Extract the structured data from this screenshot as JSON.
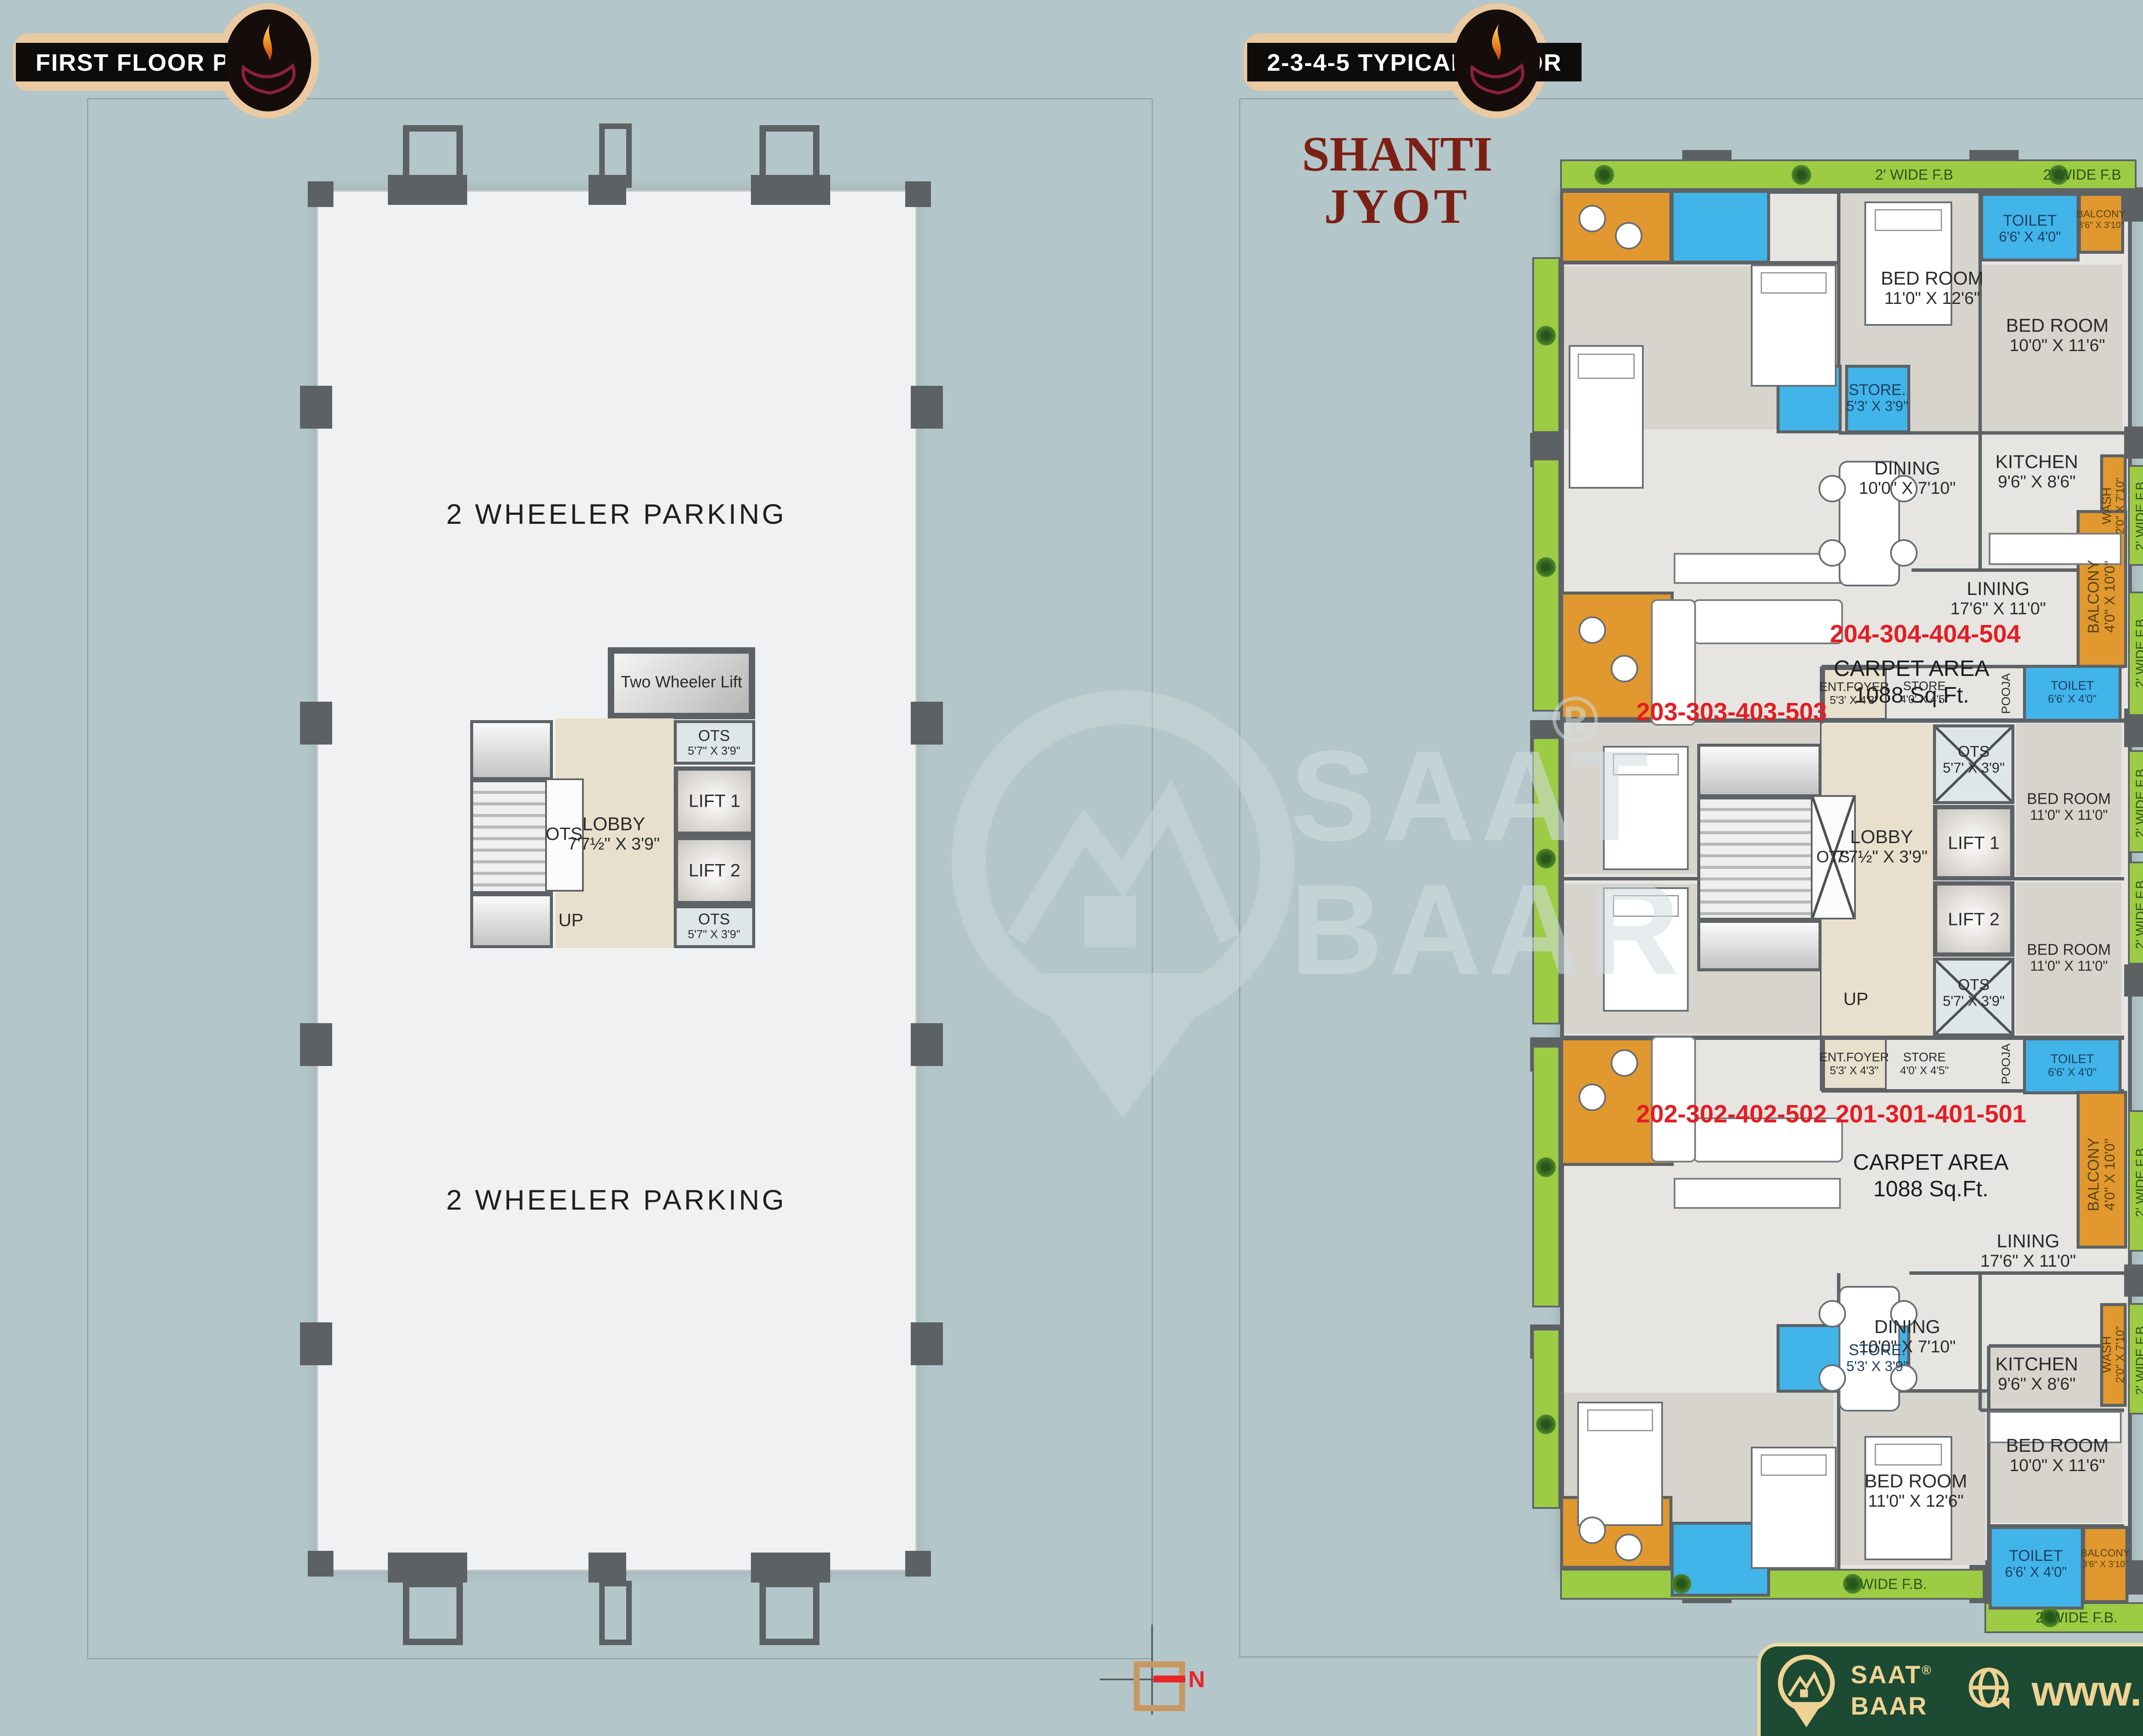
{
  "headers": {
    "left": "FIRST FLOOR PLAN",
    "right": "2-3-4-5 TYPICAL FLOOR"
  },
  "brand": {
    "line1": "SHANTI",
    "line2": "JYOT"
  },
  "watermark": {
    "word1": "SAAT",
    "word2": "BAAR",
    "reg": "®"
  },
  "north": {
    "label": "N"
  },
  "footer": {
    "name_line1": "SAAT",
    "name_line2": "BAAR",
    "reg": "®",
    "website": "www.saatbaar.com"
  },
  "left_plan": {
    "parking_top": "2 WHEELER PARKING",
    "parking_bottom": "2 WHEELER PARKING",
    "two_wheeler_lift": {
      "l1": "Two",
      "l2": "Wheeler",
      "l3": "Lift"
    },
    "ots_top": {
      "name": "OTS",
      "dim": "5'7\" X 3'9\""
    },
    "lift1": "LIFT 1",
    "lift2": "LIFT 2",
    "ots_bottom": {
      "name": "OTS",
      "dim": "5'7\" X 3'9\""
    },
    "lobby": {
      "name": "LOBBY",
      "dim": "7'7½\" X 3'9\""
    },
    "ots_stairs": "OTS",
    "up": "UP"
  },
  "right_plan": {
    "apt_204": "204-304-404-504",
    "apt_203": "203-303-403-503",
    "apt_202": "202-302-402-502",
    "apt_201": "201-301-401-501",
    "carpet": {
      "line1": "CARPET AREA",
      "line2": "1088 Sq.Ft."
    },
    "fb": "2' WIDE F.B",
    "fb_dot": "2' WIDE F.B.",
    "bed_11_126": {
      "name": "BED ROOM",
      "dim": "11'0\" X 12'6\""
    },
    "bed_10_116": {
      "name": "BED ROOM",
      "dim": "10'0\" X 11'6\""
    },
    "bed_11_11": {
      "name": "BED ROOM",
      "dim": "11'0\" X 11'0\""
    },
    "toilet": {
      "name": "TOILET",
      "dim": "6'6' X 4'0\""
    },
    "balcony_small": {
      "name": "BALCONY",
      "dim": "3'6\" X 3'10\""
    },
    "balcony_big": {
      "name": "BALCONY",
      "dim": "4'0\" X 10'0\""
    },
    "store_big": {
      "name": "STORE.",
      "dim": "5'3' X 3'9\""
    },
    "store_small": {
      "name": "STORE",
      "dim": "4'0' X 4'5\""
    },
    "ent_foyer": {
      "name": "ENT.FOYER",
      "dim": "5'3' X 4'3\""
    },
    "pooja": "POOJA",
    "wash": {
      "name": "WASH",
      "dim": "2'0\" X 7'10\""
    },
    "kitchen": {
      "name": "KITCHEN",
      "dim": "9'6\" X 8'6\""
    },
    "dining": {
      "name": "DINING",
      "dim": "10'0\" X 7'10\""
    },
    "lining": {
      "name": "LINING",
      "dim": "17'6\" X 11'0\""
    },
    "ots_x": {
      "name": "OTS",
      "dim": "5'7' X 3'9\""
    },
    "lobby": {
      "name": "LOBBY",
      "dim": "7'7½\" X 3'9\""
    },
    "lift1": "LIFT 1",
    "lift2": "LIFT 2",
    "ots_stairs": "OTS",
    "up": "UP"
  }
}
